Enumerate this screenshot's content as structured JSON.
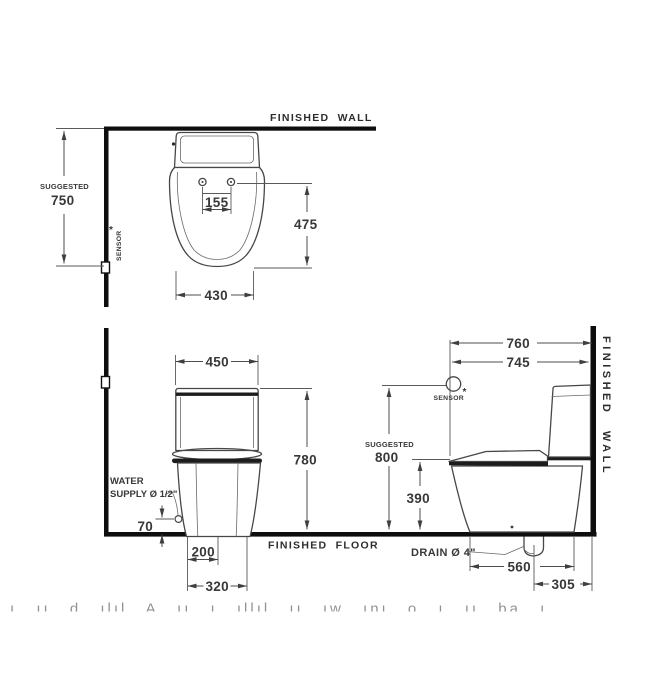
{
  "top": {
    "finished_wall": "FINISHED WALL",
    "suggested": "SUGGESTED",
    "h750": "750",
    "sensor": "SENSOR",
    "star": "*",
    "d155": "155",
    "d475": "475",
    "d430": "430"
  },
  "front": {
    "d450": "450",
    "d780": "780",
    "water1": "WATER",
    "water2": "SUPPLY Ø 1/2\"",
    "d70": "70",
    "d200": "200",
    "d320": "320"
  },
  "side": {
    "d760": "760",
    "d745": "745",
    "sensor": "SENSOR",
    "star": "*",
    "suggested": "SUGGESTED",
    "h800": "800",
    "d390": "390",
    "drain": "DRAIN Ø 4\"",
    "d560": "560",
    "d305": "305",
    "finished_wall": "FINISHED WALL"
  },
  "floor_label": "FINISHED FLOOR",
  "watermark": "ı ıı d ılıl A ıı ı ıllıl ıı ıw ını o ı ıı ba ı"
}
